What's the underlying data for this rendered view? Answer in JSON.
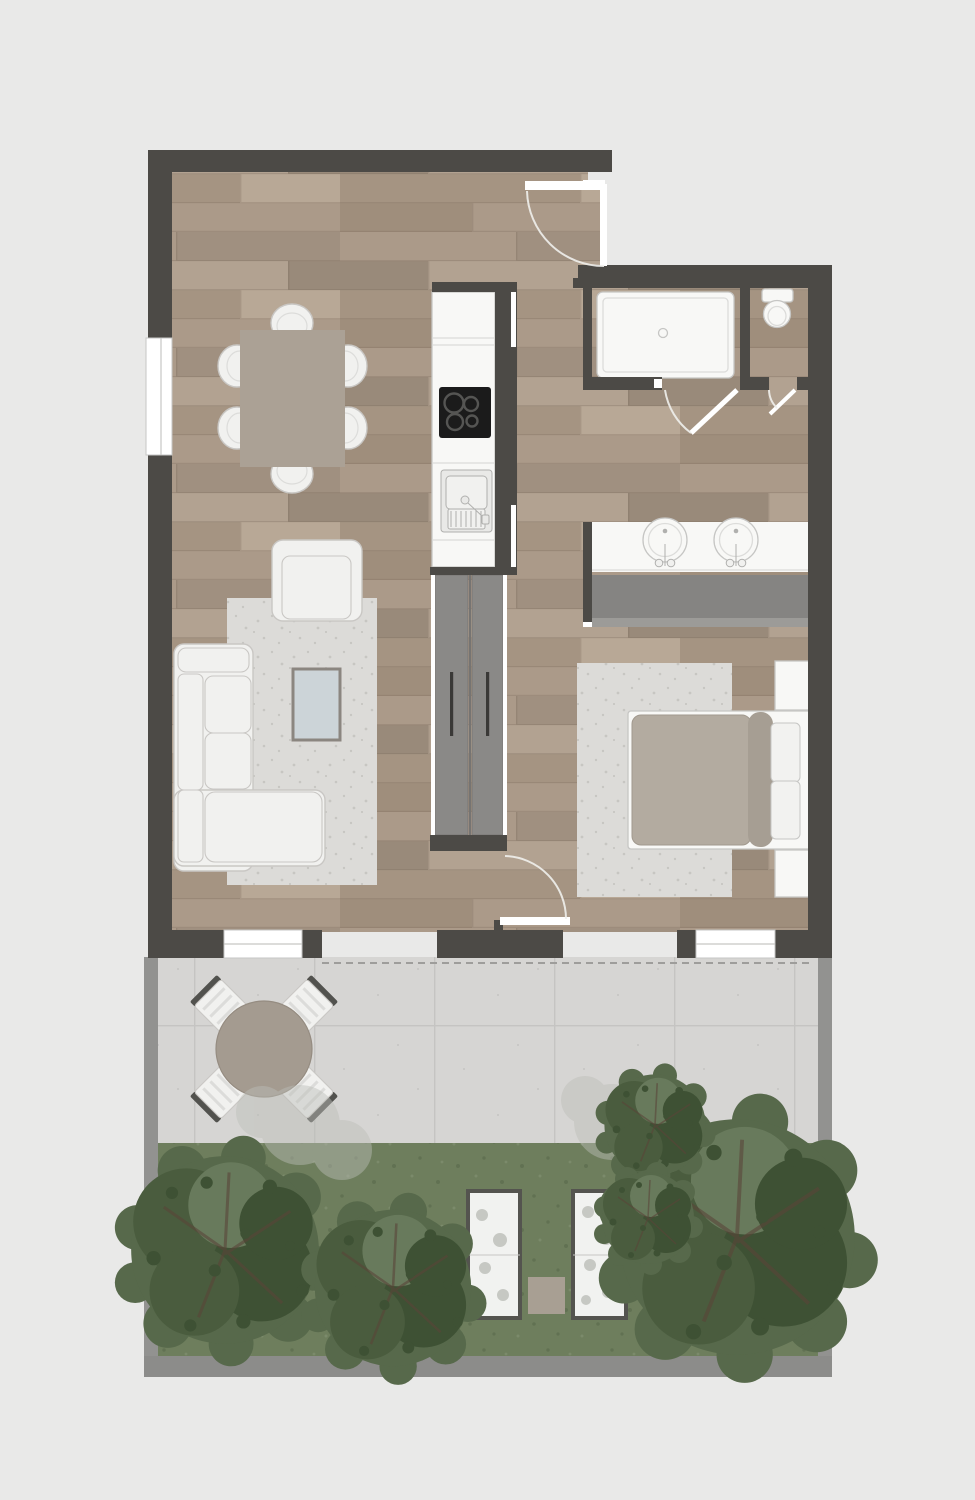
{
  "title": "Apartment floor plan with terrace and garden",
  "palette": {
    "bg": "#e9e9e8",
    "wall": "#4c4a46",
    "wood_base": "#a79683",
    "wood_b": "#ab9a89",
    "wood_c": "#a09080",
    "wood_d": "#998a7a",
    "wood_e": "#b2a291",
    "wood_f": "#a59482",
    "wood_g": "#b8a896",
    "wood_h": "#9f8e7c",
    "seam": "#776857",
    "fixture": "#f8f8f6",
    "fixborder": "#c6c6c4",
    "softline": "#dcdcda",
    "door": "#ffffff",
    "arc": "#f0efec",
    "stove": "#1b1b1b",
    "burner": "#555553",
    "sinkbox": "#e9e9e7",
    "sink_inner": "#f1f1ef",
    "sinkline": "#b0b0ae",
    "wardrobe": "#8a8987",
    "wardrobe_edge": "#767472",
    "handle": "#3a3937",
    "closet": "#858482",
    "closet_light": "#9c9b98",
    "rug": "#dcdbd8",
    "rug_dot": "#c7c6c2",
    "sofa": "#f1f1ef",
    "sofa_border": "#c9c7c4",
    "dining": "#aba195",
    "coffee": "#ccd4d8",
    "coffee_border": "#8b8680",
    "duvet": "#b3aba0",
    "duvet_edge": "#a1998e",
    "bolster": "#a69e93",
    "pillow": "#f2f2f0",
    "tile": "#d6d5d3",
    "tile_line": "#c5c4c2",
    "grass": "#6e7e5d",
    "grass_dark": "#617152",
    "grass_light": "#7b8a6b",
    "tree": "#57694b",
    "tree_mid": "#4a5c3e",
    "tree_dark": "#3e5134",
    "tree_light": "#687a5c",
    "branch": "#5a4538",
    "boundary": "#929290",
    "boundary2": "#8c8c8a",
    "dash": "#9e9d9b",
    "ttable": "#a49b90",
    "ttable_border": "#958c81",
    "chairband": "#52524e",
    "planter": "#f1f2f0",
    "planter_border": "#54544f",
    "pad": "#a89f93",
    "ghost": "#bcbeb8"
  },
  "labels": {
    "plan": "apartment floor plan",
    "living_dining": "living and dining area",
    "kitchen": "kitchen",
    "entry": "entry",
    "bathroom": "bathroom with shower",
    "wc": "wc",
    "bedroom": "bedroom",
    "hallway": "hallway with wardrobe",
    "terrace": "terrace",
    "garden": "garden"
  },
  "inventory": {
    "dining_chairs": 6,
    "dining_tables": 1,
    "sofas": 1,
    "armchairs": 1,
    "coffee_tables": 1,
    "cooktop_burners": 4,
    "kitchen_sinks": 1,
    "wardrobe_doors": 2,
    "showers": 1,
    "toilets": 1,
    "vanity_basins": 2,
    "beds": 1,
    "nightstands": 2,
    "terrace_chairs": 4,
    "terrace_tables": 1,
    "planters": 2,
    "trees": 3
  }
}
